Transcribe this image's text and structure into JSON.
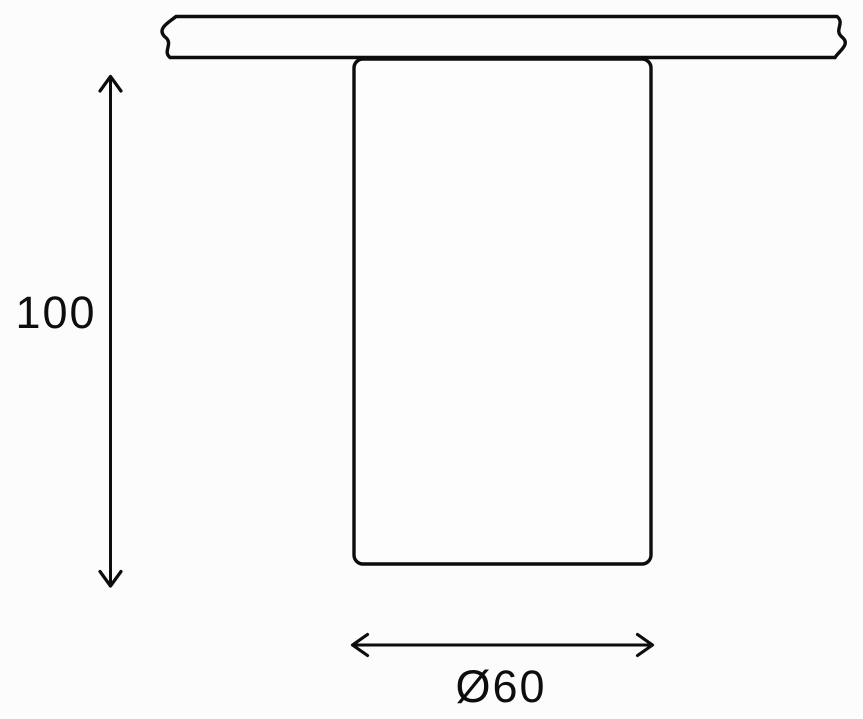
{
  "page": {
    "background_color": "#fcfcfc"
  },
  "diagram": {
    "type": "technical-dimension-drawing",
    "subject": "surface-mounted cylindrical ceiling spotlight, side elevation",
    "line_color": "#0d0d0d",
    "body_fill_color": "#fdfdfd",
    "parts": {
      "ceiling": "hatched ceiling cross-section with break-line ends",
      "body": "cylindrical fixture body hanging below ceiling"
    },
    "dimensions": {
      "height": {
        "label": "100",
        "orientation": "vertical",
        "measures": "fixture body height"
      },
      "diameter": {
        "label": "Ø60",
        "orientation": "horizontal",
        "measures": "fixture body diameter"
      }
    }
  }
}
